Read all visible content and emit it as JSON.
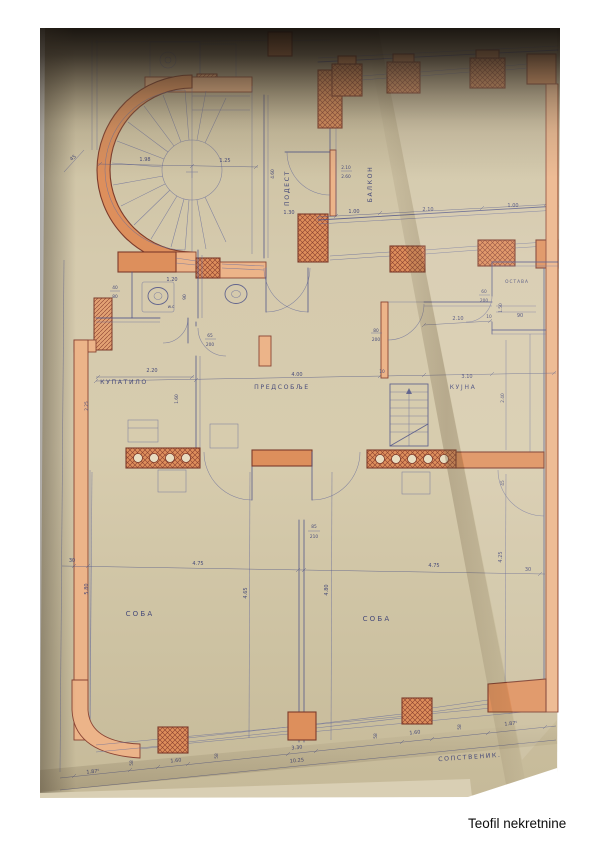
{
  "watermark": "Teofil nekretnine",
  "rooms": {
    "podest": "ПОДЕСТ",
    "balkon": "БАЛКОН",
    "wc": "w.c",
    "kupatilo": "КУПАТИЛО",
    "predsoblje": "ПРЕДСОБЉЕ",
    "kujna": "КУЈНА",
    "ostava": "ОСТАВА",
    "soba_left": "СОБА",
    "soba_right": "СОБА",
    "sopstvenik": "СОПСТВЕНИК."
  },
  "dims": {
    "stair_w1": "1.98",
    "stair_w2": "1.25",
    "diag45": "45",
    "v460": "4.60",
    "balk_a": "2.10",
    "balk_b": "2.60",
    "row1_a": "1.30",
    "row1_b": "1.00",
    "row1_c": "2.10",
    "row1_d": "1.00",
    "wc_a": "40",
    "wc_b": "80",
    "wc_w": "1.20",
    "wc_d": "90",
    "bath_door_w": "65",
    "bath_door_h": "200",
    "kuj_door_w": "80",
    "kuj_door_h": "200",
    "ost_door_w": "60",
    "ost_door_h": "200",
    "ost_d": "1.50",
    "ost_row_a": "2.10",
    "ost_row_b": "10",
    "ost_row_c": "90",
    "bath_w": "2.20",
    "bath_d1": "2.25",
    "bath_d2": "1.60",
    "pred_w": "4.00",
    "wall10": "10",
    "kuj_w": "3.10",
    "kuj_d": "2.40",
    "door85_a": "85",
    "door85_b": "210",
    "w45": "45",
    "mid_30l": "30",
    "mid_475l": "4.75",
    "mid_475r": "4.75",
    "mid_30r": "30",
    "v580": "5.80",
    "v465": "4.65",
    "v480": "4.80",
    "v425": "4.25",
    "b_187l": "1.87⁵",
    "b_58a": "58",
    "b_160l": "1.60",
    "b_58b": "58",
    "b_330": "3.30",
    "b_1025": "10.25",
    "b_58c": "58",
    "b_160r": "1.60",
    "b_58d": "58",
    "b_187r": "1.87⁵"
  }
}
